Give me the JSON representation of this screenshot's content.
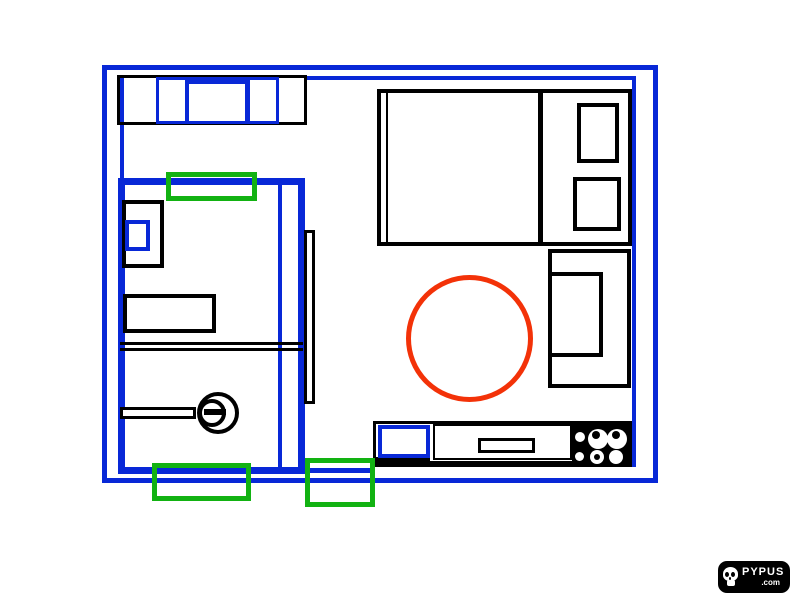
{
  "colors": {
    "ink": "#000000",
    "paper": "#ffffff",
    "blue": "#0828d7",
    "green": "#12b212",
    "red": "#f33208"
  },
  "logo": {
    "brand": "PYPUS",
    "tld": ".com",
    "icon": "skull-icon"
  },
  "elements": [
    "outer-wall-border",
    "inner-wall-top-line",
    "inner-wall-left-line",
    "inner-wall-right-line",
    "sofa",
    "sofa-cushions",
    "bed",
    "bed-pillow",
    "armchair",
    "round-rug",
    "bathroom-walls",
    "bathroom-divider-line",
    "washing-machine",
    "bathroom-sink",
    "shelf-double-line",
    "towel-bar",
    "drain-circles",
    "door-leaf",
    "kitchen-counter",
    "kitchen-sink",
    "drawer-handle",
    "stove-burners",
    "green-highlight-rectangle"
  ]
}
